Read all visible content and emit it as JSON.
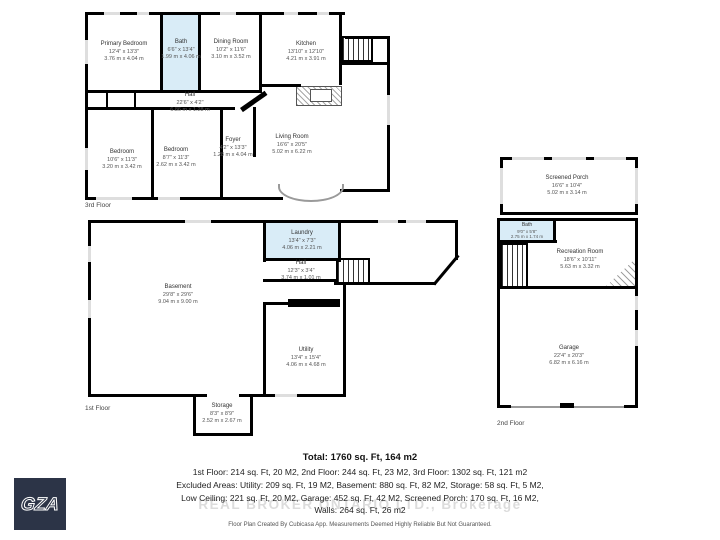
{
  "floors": {
    "third": {
      "label": "3rd Floor"
    },
    "first": {
      "label": "1st Floor"
    },
    "second": {
      "label": "2nd Floor"
    }
  },
  "rooms": {
    "primary_bedroom": {
      "name": "Primary Bedroom",
      "ft": "12'4\" x 13'3\"",
      "m": "3.76 m x 4.04 m"
    },
    "bath3": {
      "name": "Bath",
      "ft": "6'6\" x 13'4\"",
      "m": "1.99 m x 4.06 m"
    },
    "dining": {
      "name": "Dining Room",
      "ft": "10'2\" x 11'6\"",
      "m": "3.10 m x 3.52 m"
    },
    "kitchen": {
      "name": "Kitchen",
      "ft": "13'10\" x 12'10\"",
      "m": "4.21 m x 3.91 m"
    },
    "hall3": {
      "name": "Hall",
      "ft": "22'6\" x 4'2\"",
      "m": "6.86 m x 1.28 m"
    },
    "bedroom_left": {
      "name": "Bedroom",
      "ft": "10'6\" x 11'3\"",
      "m": "3.20 m x 3.42 m"
    },
    "bedroom_mid": {
      "name": "Bedroom",
      "ft": "8'7\" x 11'3\"",
      "m": "2.62 m x 3.42 m"
    },
    "foyer": {
      "name": "Foyer",
      "ft": "4'2\" x 13'3\"",
      "m": "1.28 m x 4.04 m"
    },
    "living": {
      "name": "Living Room",
      "ft": "16'6\" x 20'5\"",
      "m": "5.02 m x 6.22 m"
    },
    "basement": {
      "name": "Basement",
      "ft": "29'8\" x 29'6\"",
      "m": "9.04 m x 9.00 m"
    },
    "laundry": {
      "name": "Laundry",
      "ft": "13'4\" x 7'3\"",
      "m": "4.06 m x 2.21 m"
    },
    "hall1": {
      "name": "Hall",
      "ft": "12'3\" x 3'4\"",
      "m": "3.74 m x 1.01 m"
    },
    "utility": {
      "name": "Utility",
      "ft": "13'4\" x 15'4\"",
      "m": "4.06 m x 4.68 m"
    },
    "storage": {
      "name": "Storage",
      "ft": "8'3\" x 8'9\"",
      "m": "2.52 m x 2.67 m"
    },
    "screened_porch": {
      "name": "Screened Porch",
      "ft": "16'6\" x 10'4\"",
      "m": "5.02 m x 3.14 m"
    },
    "bath2": {
      "name": "Bath",
      "ft": "9'0\" x 5'8\"",
      "m": "2.75 m x 1.74 m"
    },
    "rec_room": {
      "name": "Recreation Room",
      "ft": "18'6\" x 10'11\"",
      "m": "5.63 m x 3.32 m"
    },
    "garage": {
      "name": "Garage",
      "ft": "22'4\" x 20'3\"",
      "m": "6.82 m x 6.16 m"
    }
  },
  "summary": {
    "total": "Total: 1760 sq. Ft, 164 m2",
    "line1": "1st Floor: 214 sq. Ft, 20 M2, 2nd Floor: 244 sq. Ft, 23 M2, 3rd Floor: 1302 sq. Ft, 121 m2",
    "line2": "Excluded Areas: Utility: 209 sq. Ft, 19 M2, Basement: 880 sq. Ft, 82 M2, Storage: 58 sq. Ft, 5 M2,",
    "line3": "Low Ceiling: 221 sq. Ft, 20 M2, Garage: 452 sq. Ft, 42 M2, Screened Porch: 170 sq. Ft, 16 M2,",
    "line4": "Walls: 264 sq. Ft, 26 m2"
  },
  "watermark": "REAL BROKER ONTARIO LTD., Brokerage",
  "disclaimer": "Floor Plan Created By Cubicasa App. Measurements Deemed Highly Reliable But Not Guaranteed.",
  "logo": {
    "text": "GZA"
  },
  "colors": {
    "wall": "#000000",
    "wet_room": "#d9ecf7",
    "window": "#dedede",
    "logo_bg": "#2c3447"
  }
}
